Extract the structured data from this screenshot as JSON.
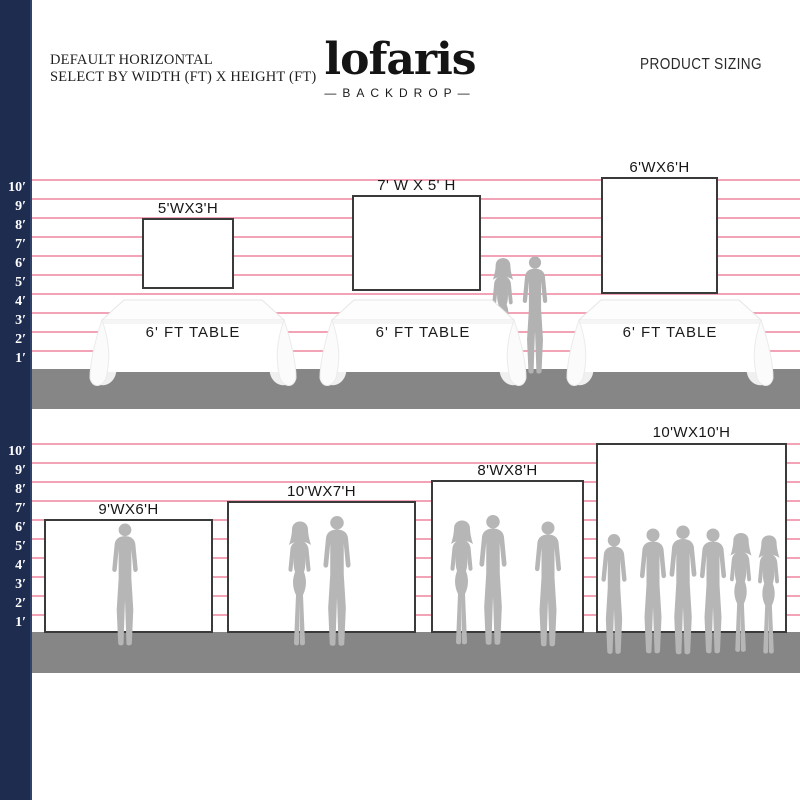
{
  "header": {
    "line1": "DEFAULT HORIZONTAL",
    "line2": "SELECT BY WIDTH (FT) X HEIGHT (FT)",
    "brand": "lofaris",
    "brand_tagline": "—BACKDROP—",
    "page_label": "PRODUCT SIZING"
  },
  "ruler_labels": [
    "10′",
    "9′",
    "8′",
    "7′",
    "6′",
    "5′",
    "4′",
    "3′",
    "2′",
    "1′"
  ],
  "table_label": "6' FT TABLE",
  "backdrops": {
    "row1": [
      {
        "label": "5'WX3'H",
        "width_ft": 5,
        "height_ft": 3
      },
      {
        "label": "7' W X 5' H",
        "width_ft": 7,
        "height_ft": 5
      },
      {
        "label": "6'WX6'H",
        "width_ft": 6,
        "height_ft": 6
      }
    ],
    "row2": [
      {
        "label": "9'WX6'H",
        "width_ft": 9,
        "height_ft": 6
      },
      {
        "label": "10'WX7'H",
        "width_ft": 10,
        "height_ft": 7
      },
      {
        "label": "8'WX8'H",
        "width_ft": 8,
        "height_ft": 8
      },
      {
        "label": "10'WX10'H",
        "width_ft": 10,
        "height_ft": 10
      }
    ]
  },
  "colors": {
    "ruler_bar": "#1e2c50",
    "grid_line": "#f2a4b6",
    "floor": "#868686",
    "backdrop_border": "#3a3a3a",
    "silhouette": "#b6b6b6"
  }
}
